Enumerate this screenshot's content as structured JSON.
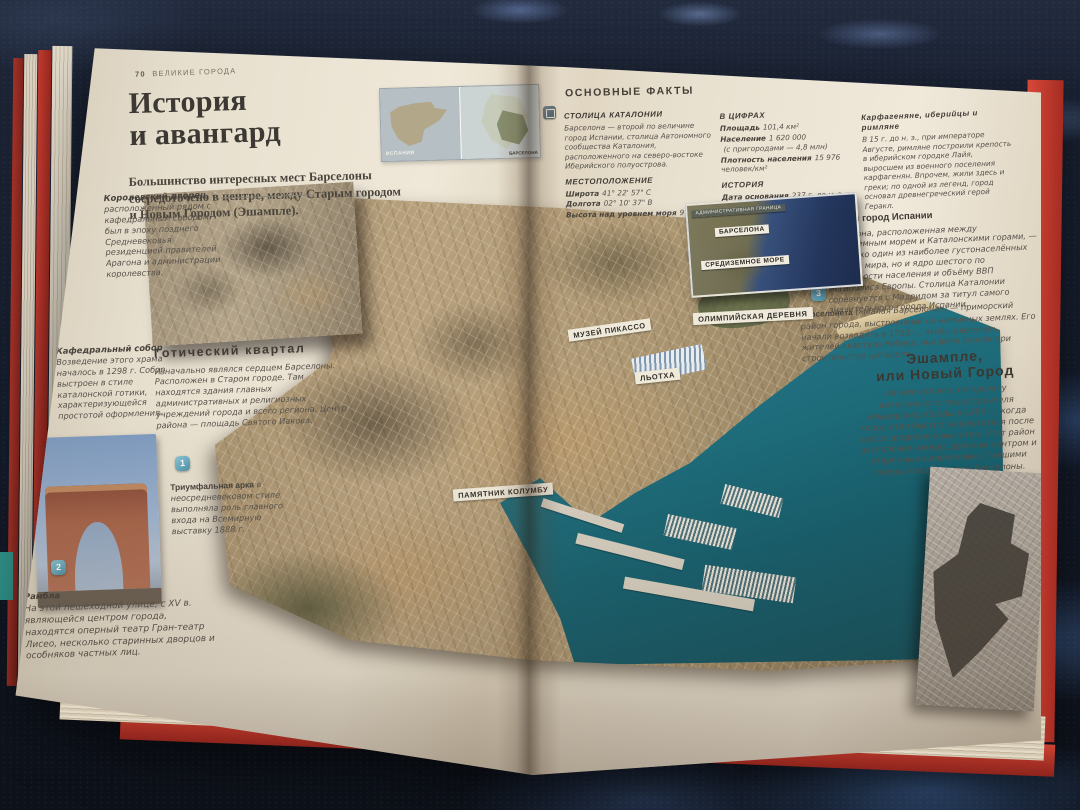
{
  "left": {
    "page_number": "70",
    "section_header": "ВЕЛИКИЕ ГОРОДА",
    "title_line1": "История",
    "title_line2": "и авангард",
    "intro": "Большинство интересных мест Барселоны сосредоточено в центре, между Старым городом и Новым Городом (Эшампле).",
    "spain_inset_label": "ИСПАНИЯ",
    "region_inset_label": "БАРСЕЛОНА",
    "royal_note_title": "Королевский дворец,",
    "royal_note_text": "расположенный рядом с кафедральным собором, был в эпоху позднего Средневековья резиденцией правителей Арагона и администрации королевства.",
    "cathedral_title": "Кафедральный собор",
    "cathedral_text": "Возведение этого храма началось в 1298 г. Собор выстроен в стиле каталонской готики, характеризующейся простотой оформления.",
    "gothic_title": "Готический квартал",
    "gothic_text": "Изначально являлся сердцем Барселоны. Расположен в Старом городе. Там находятся здания главных административных и религиозных учреждений города и всего региона. Центр района — площадь Святого Иакова.",
    "badge_1": "1",
    "arch_title": "Триумфальная арка",
    "arch_text": "в неосредневековом стиле выполняла роль главного входа на Всемирную выставку 1888 г.",
    "badge_2": "2",
    "rambla_title": "Рамбла",
    "rambla_text": "На этой пешеходной улице, с XV в. являющейся центром города, находятся оперный театр Гран-театр Лисео, несколько старинных дворцов и особняков частных лиц."
  },
  "right": {
    "page_number": "71",
    "section_header": "Барселона",
    "facts_header": "ОСНОВНЫЕ ФАКТЫ",
    "capital_title": "СТОЛИЦА КАТАЛОНИИ",
    "capital_text": "Барселона — второй по величине город Испании, столица Автономного сообщества Каталония, расположенного на северо-востоке Иберийского полуострова.",
    "location_title": "МЕСТОПОЛОЖЕНИЕ",
    "location_rows": [
      {
        "label": "Широта",
        "value": "41° 22' 57\" С"
      },
      {
        "label": "Долгота",
        "value": "02° 10' 37\" В"
      },
      {
        "label": "Высота над уровнем моря",
        "value": "9 м"
      }
    ],
    "numbers_title": "В ЦИФРАХ",
    "numbers_rows": [
      {
        "label": "Площадь",
        "value": "101,4 км²"
      },
      {
        "label": "Население",
        "value": "1 620 000"
      },
      {
        "label": "",
        "value": "(с пригородами — 4,8 млн)"
      },
      {
        "label": "Плотность населения",
        "value": "15 976 человек/км²"
      }
    ],
    "history_title": "ИСТОРИЯ",
    "history_rows": [
      {
        "label": "Дата основания",
        "value": "237 г. до н. э."
      },
      {
        "label": "Основатели",
        "value": "Карфагенский полководец Гамилькар Барка"
      }
    ],
    "carthage_title": "Карфагеняне, иберийцы и римляне",
    "carthage_text": "В 15 г. до н. э., при императоре Августе, римляне построили крепость в иберийском городке Лайя, выросшем из военного поселения карфагенян. Впрочем, жили здесь и греки; по одной из легенд, город основал древнегреческий герой Геракл.",
    "second_city_title": "Второй город Испании",
    "second_city_text": "Барселона, расположенная между Средиземным морем и Каталонскими горами, — не только один из наиболее густонаселённых городов мира, но и ядро шестого по численности населения и объёму ВВП мегаполиса Европы. Столица Каталонии соревнуется с Мадридом за титул самого значительного города Испании.",
    "badge_3": "3",
    "barceloneta_title": "Барселонета",
    "barceloneta_text": "(«Малая Барселона») — приморский район города, выстроенный на намывных землях. Его начали возводить в 1753 г., чтобы расселить жителей квартала Рибера, чьи дома снесли при строительстве цитадели.",
    "eixample_title_line1": "Эшампле,",
    "eixample_title_line2": "или Новый Город",
    "eixample_text": "начали строить по проекту каталонского градостроителя Ильдефонса Серды в 1856 г., когда город стал быстро разрастаться после сноса средневековых стен. Этот район расположен между древним центром и старинными деревнями, ставшими теперь предместьями Барселоны."
  },
  "map_labels": {
    "admin_border": "АДМИНИСТРАТИВНАЯ ГРАНИЦА",
    "barcelona": "БАРСЕЛОНА",
    "mediterranean": "СРЕДИЗЕМНОЕ МОРЕ",
    "picasso_museum": "МУЗЕЙ ПИКАССО",
    "llotja": "ЛЬОТХА",
    "olympic_village": "ОЛИМПИЙСКАЯ ДЕРЕВНЯ",
    "columbus_monument": "ПАМЯТНИК КОЛУМБУ"
  },
  "colors": {
    "cover_red": "#c23b30",
    "badge_blue": "#5fa8bd",
    "sea_teal": "#2e7d8c",
    "page_cream": "#e9e1d0",
    "map_label_bg": "#efe9da"
  }
}
